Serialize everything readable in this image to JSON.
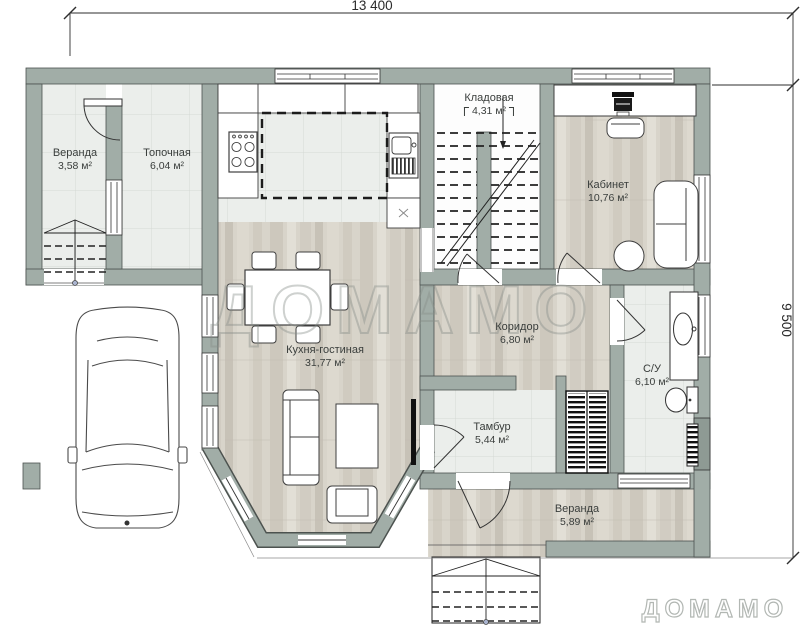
{
  "dimensions": {
    "width": "13 400",
    "height": "9 500"
  },
  "watermark": {
    "text": "ДОМАМО"
  },
  "brand": {
    "logo": "ДОМАМО"
  },
  "rooms": [
    {
      "name": "Веранда",
      "area": "3,58 м²"
    },
    {
      "name": "Топочная",
      "area": "6,04 м²"
    },
    {
      "name": "Кладовая",
      "area": "4,31 м²"
    },
    {
      "name": "Кабинет",
      "area": "10,76 м²"
    },
    {
      "name": "Кухня-гостиная",
      "area": "31,77 м²"
    },
    {
      "name": "Коридор",
      "area": "6,80 м²"
    },
    {
      "name": "С/У",
      "area": "6,10 м²"
    },
    {
      "name": "Тамбур",
      "area": "5,44 м²"
    },
    {
      "name": "Веранда",
      "area": "5,89 м²"
    }
  ],
  "colors": {
    "wall": "#a1ada7",
    "tile": "#ebeeeb",
    "wood": "#d8d4ca",
    "accent_dark": "#3a3e3c"
  }
}
